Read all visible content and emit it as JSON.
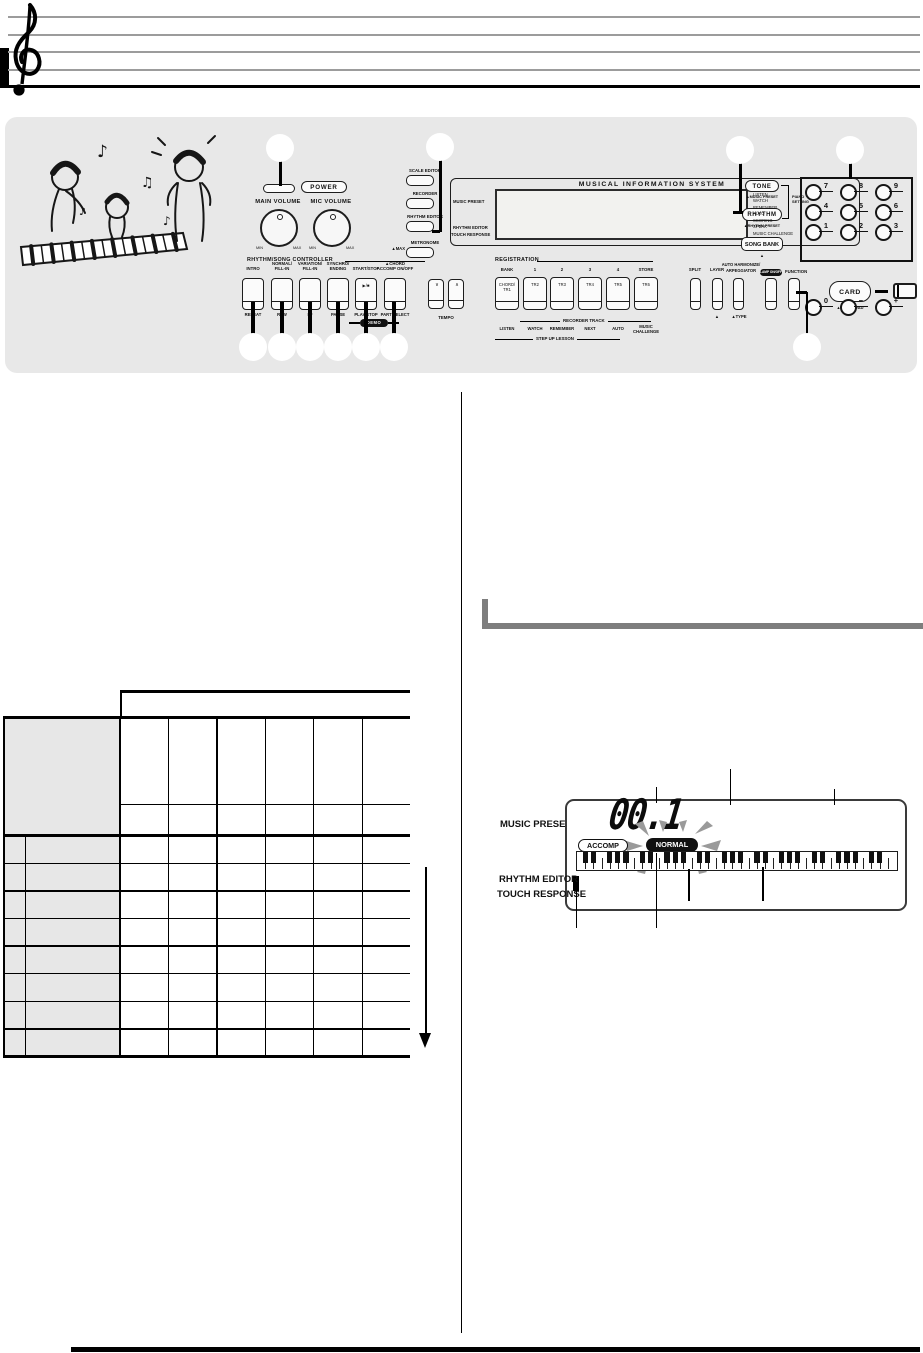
{
  "panel": {
    "power_button_label": "POWER",
    "main_volume_label": "MAIN VOLUME",
    "mic_volume_label": "MIC VOLUME",
    "min_label": "MIN",
    "max_label": "MAX",
    "side_buttons": [
      "SCALE EDITOR",
      "RECORDER",
      "RHYTHM EDITOR",
      "METRONOME"
    ],
    "metronome_note": "▲MAX",
    "display": {
      "title": "MUSICAL INFORMATION SYSTEM",
      "music_preset_label": "MUSIC PRESET",
      "rhythm_editor_label": "RHYTHM EDITOR",
      "touch_response_label": "TOUCH RESPONSE",
      "indicators": [
        "LISTEN",
        "WATCH",
        "REMEMBER",
        "AUTO",
        "SCORING",
        "SPEAK",
        "MUSIC CHALLENGE"
      ]
    },
    "tone_button": "TONE",
    "tone_sub": "▲MUSIC PRESET",
    "piano_setting": "PIANO SETTING",
    "rhythm_button": "RHYTHM",
    "rhythm_sub": "▲RHYTHM PRESET",
    "song_bank_button": "SONG BANK",
    "song_bank_sub": "▲",
    "numpad": [
      [
        "7",
        "8",
        "9"
      ],
      [
        "4",
        "5",
        "6"
      ],
      [
        "1",
        "2",
        "3"
      ],
      [
        "0",
        "−",
        "+"
      ]
    ],
    "rhythm_song_controller": {
      "title": "RHYTHM/SONG CONTROLLER",
      "top_labels": [
        [
          "INTRO"
        ],
        [
          "NORMAL/",
          "FILL-IN"
        ],
        [
          "VARIATION/",
          "FILL-IN"
        ],
        [
          "SYNCHRO/",
          "ENDING"
        ],
        [
          "START/STOP"
        ],
        [
          "▲CHORD",
          "ACCOMP ON/OFF"
        ]
      ],
      "inner_labels": [
        "",
        "",
        "",
        "",
        "▶/■",
        ""
      ],
      "bottom_labels": [
        "REPEAT",
        "REW",
        "FF",
        "PAUSE",
        "PLAY/STOP",
        "PART SELECT"
      ],
      "demo_badge": "DEMO"
    },
    "tempo": {
      "down": "∨",
      "up": "∧",
      "label": "TEMPO"
    },
    "registration": {
      "title": "REGISTRATION",
      "top_labels": [
        "BANK",
        "1",
        "2",
        "3",
        "4",
        "STORE"
      ],
      "button_labels": [
        "CHORD/\nTR1",
        "TR2",
        "TR3",
        "TR4",
        "TR5",
        "TR6"
      ],
      "recorder_track": "RECORDER TRACK",
      "lesson_labels": [
        "LISTEN",
        "WATCH",
        "REMEMBER",
        "NEXT",
        "AUTO",
        "MUSIC\nCHALLENGE"
      ],
      "step_up": "STEP UP LESSON"
    },
    "right_controls": {
      "split": "SPLIT",
      "layer": "LAYER",
      "layer_sub": "▲",
      "auto_harmonize_1": "AUTO HARMONIZE/",
      "auto_harmonize_2": "ARPEGGIATOR",
      "auto_sub": "▲TYPE",
      "lamp_badge": "LAMP ON/OFF",
      "function_label": "FUNCTION",
      "card_button": "CARD",
      "card_sub": "▲SAVE/LOAD"
    }
  },
  "lcd_diagram": {
    "music_preset_label": "MUSIC PRESET",
    "value": "00.1",
    "accomp_badge": "ACCOMP",
    "normal_badge": "NORMAL",
    "rhythm_editor_label": "RHYTHM EDITOR",
    "touch_response_label": "TOUCH RESPONSE"
  },
  "table": {
    "columns": 6,
    "data_rows": 8
  }
}
